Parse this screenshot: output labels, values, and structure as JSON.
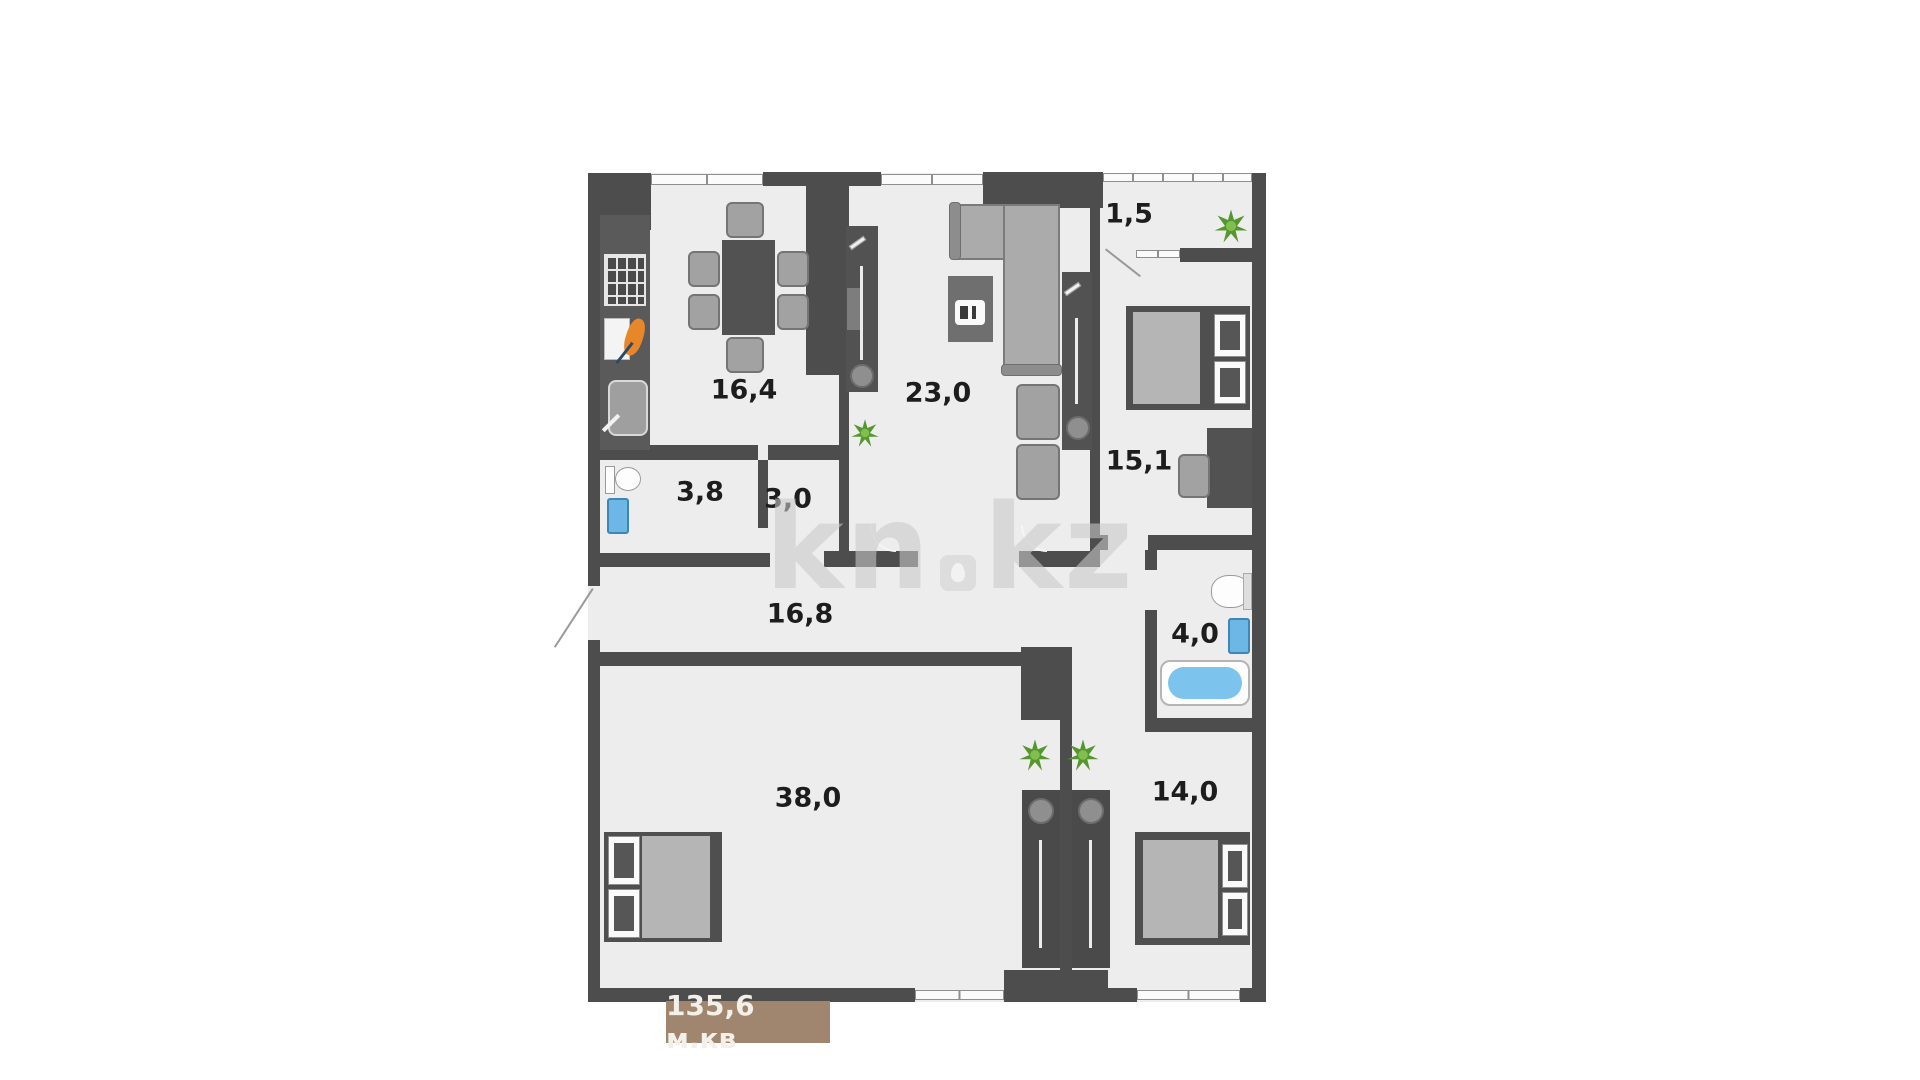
{
  "watermark": {
    "left": "kn",
    "right": "kz"
  },
  "total_area_label": "135,6 м.кв",
  "rooms": {
    "kitchen_dining": {
      "area": "16,4"
    },
    "living_room": {
      "area": "23,0"
    },
    "balcony": {
      "area": "1,5"
    },
    "bedroom_right": {
      "area": "15,1"
    },
    "toilet": {
      "area": "3,8"
    },
    "corridor_small": {
      "area": "3,0"
    },
    "hallway": {
      "area": "16,8"
    },
    "bathroom": {
      "area": "4,0"
    },
    "bedroom_large": {
      "area": "38,0"
    },
    "bedroom_bottom": {
      "area": "14,0"
    }
  },
  "colors": {
    "wall": "#4d4d4d",
    "room_fill": "#ededed",
    "water_accent": "#7cc3ed",
    "badge_background": "#a0866e",
    "watermark_gray": "#c9c9c9",
    "plant_green": "#55962e",
    "carrot_orange": "#e8862a"
  },
  "furniture_icons": [
    "dining-table",
    "chair",
    "stove",
    "cutting-board",
    "kitchen-sink",
    "toilet",
    "washing-machine",
    "corner-sofa",
    "coffee-table",
    "tv-unit",
    "armchair",
    "wardrobe-with-mirror",
    "double-bed",
    "desk",
    "bathroom-sink",
    "bathtub",
    "tall-cabinet",
    "plant"
  ]
}
